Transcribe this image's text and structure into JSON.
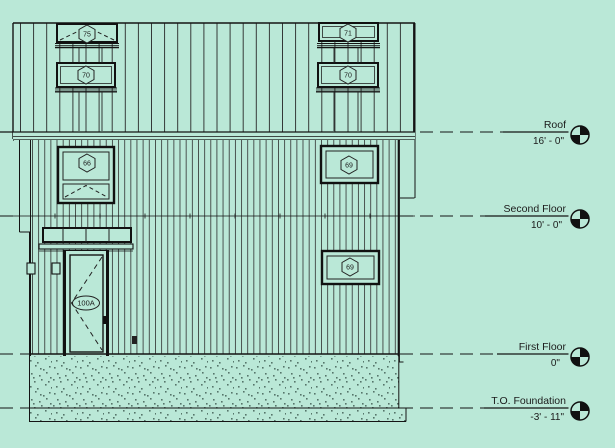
{
  "drawing": {
    "type": "building-elevation",
    "colors": {
      "background": "#BAE8D7",
      "line": "#1B1B1B",
      "stipple": "#55756A"
    },
    "levels": [
      {
        "name": "Roof",
        "elevation": "16' - 0\""
      },
      {
        "name": "Second Floor",
        "elevation": "10' - 0\""
      },
      {
        "name": "First Floor",
        "elevation": "0\""
      },
      {
        "name": "T.O. Foundation",
        "elevation": "-3' - 11\""
      }
    ],
    "window_tags": {
      "upper_left_top": "75",
      "upper_left_bottom": "70",
      "upper_right_top": "71",
      "upper_right_bottom": "70",
      "second_floor_left": "66",
      "second_floor_right": "69",
      "first_floor_right": "69"
    },
    "door_tag": "100A"
  }
}
